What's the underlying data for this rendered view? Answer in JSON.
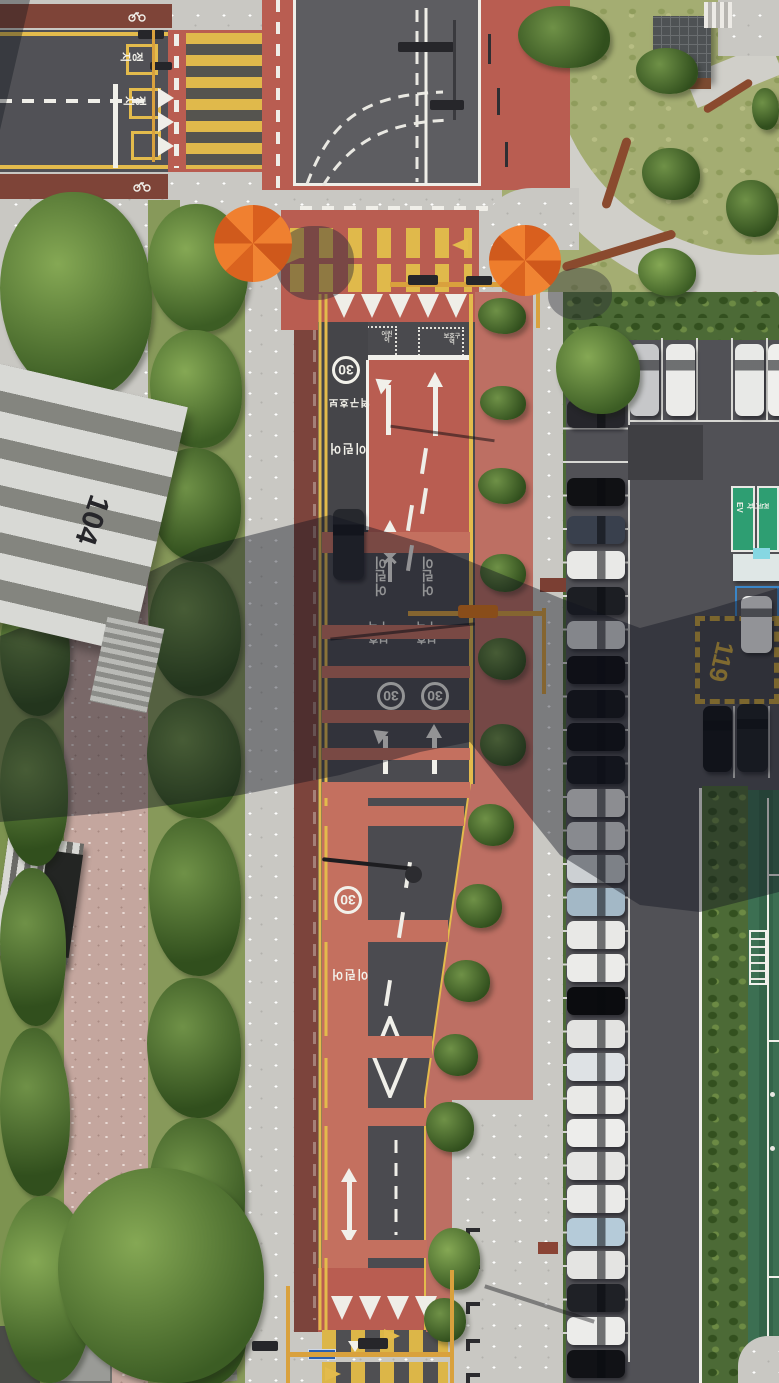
{
  "scene": {
    "type": "aerial-drone-photo",
    "description": "Top-down aerial view of a Korean school-zone street with red-painted speed zones, crosswalks, a parking lot full of cars, an apartment building casting a long diagonal shadow, a small park and a football pitch"
  },
  "texts": {
    "building_number": "104",
    "speed_limit": "30",
    "school_zone_word1": "어린이",
    "school_zone_word2": "보호구역",
    "stop_marking": "정지",
    "fire_lane_number": "119",
    "ev_label": "EV",
    "ev_korean": "전기차"
  },
  "palette": {
    "red_paint": "#b95d51",
    "red_band": "#c4705f",
    "crosswalk_yellow": "#e0b94b",
    "asphalt": "#515156",
    "sidewalk": "#c9c8c3",
    "pink_path": "#c4a69e",
    "grass": "#a4ad72",
    "field_green": "#3c6f52",
    "umbrella_orange": "#ef8030",
    "ev_green": "#2e9e72",
    "disabled_blue": "#3a86c8",
    "shadow": "rgba(16,20,30,0.42)"
  },
  "markings": {
    "bands": [
      [
        532,
        21,
        470
      ],
      [
        625,
        14,
        470
      ],
      [
        666,
        12,
        470
      ],
      [
        710,
        13,
        470
      ],
      [
        748,
        12,
        470
      ],
      [
        782,
        16,
        470
      ],
      [
        806,
        20,
        464
      ],
      [
        920,
        22,
        448
      ],
      [
        1036,
        22,
        432
      ],
      [
        1108,
        18,
        427
      ],
      [
        1240,
        18,
        427
      ]
    ],
    "teeth_down": [
      {
        "y": 294,
        "xs": [
          333,
          361,
          389,
          417,
          445
        ]
      },
      {
        "y": 1296,
        "xs": [
          331,
          359,
          387,
          415
        ]
      }
    ],
    "teeth_right": {
      "x": 158,
      "ys": [
        88,
        112,
        136
      ]
    },
    "diag_dashes": [
      [
        406,
        862
      ],
      [
        399,
        912
      ],
      [
        386,
        980
      ],
      [
        408,
        505
      ],
      [
        408,
        545
      ],
      [
        422,
        448
      ],
      [
        422,
        488
      ]
    ],
    "speed_arrows": [
      [
        286,
        250,
        0
      ],
      [
        452,
        238,
        1
      ],
      [
        384,
        1329,
        0
      ],
      [
        325,
        1367,
        0
      ]
    ]
  },
  "parking": {
    "left_column": [
      [
        400,
        "#26262b"
      ],
      [
        478,
        "#101114"
      ],
      [
        516,
        "#39404d"
      ],
      [
        551,
        "#e9e9e7"
      ],
      [
        587,
        "#1c1e23"
      ],
      [
        621,
        "#d8d9da"
      ],
      [
        656,
        "#0e0f12"
      ],
      [
        690,
        "#141519"
      ],
      [
        723,
        "#0f1013"
      ],
      [
        756,
        "#16181d"
      ],
      [
        789,
        "#e6e6e4"
      ],
      [
        822,
        "#dfe0e0"
      ],
      [
        855,
        "#ccd0d3"
      ],
      [
        888,
        "#a3b8c6"
      ],
      [
        921,
        "#e8e8e6"
      ],
      [
        954,
        "#ebebe9"
      ],
      [
        987,
        "#0b0c0f"
      ],
      [
        1020,
        "#e3e3e1"
      ],
      [
        1053,
        "#dee2e5"
      ],
      [
        1086,
        "#e9e9e7"
      ],
      [
        1119,
        "#ededeb"
      ],
      [
        1152,
        "#e6e6e4"
      ],
      [
        1185,
        "#eaeae8"
      ],
      [
        1218,
        "#b5cbd9"
      ],
      [
        1251,
        "#e4e4e2"
      ],
      [
        1284,
        "#1f2126"
      ],
      [
        1317,
        "#ececea"
      ],
      [
        1350,
        "#111216"
      ]
    ],
    "top_row": [
      [
        630,
        "#c6c7c9"
      ],
      [
        666,
        "#ebebe9"
      ],
      [
        735,
        "#e8e9e7"
      ],
      [
        768,
        "#efefed"
      ]
    ],
    "right_pair": [
      [
        703,
        706,
        29,
        66,
        "#121317"
      ],
      [
        737,
        704,
        31,
        68,
        "#1d1f24"
      ]
    ],
    "blue_stall_car": [
      741,
      596,
      31,
      57,
      "#f0f0ee"
    ]
  },
  "vehicles": {
    "van_on_road": [
      333,
      509,
      31,
      71,
      "#26282d"
    ]
  },
  "vegetation": [
    [
      0,
      192,
      152,
      206,
      0
    ],
    [
      148,
      204,
      100,
      128,
      0
    ],
    [
      150,
      330,
      92,
      118,
      0
    ],
    [
      151,
      448,
      90,
      114,
      1
    ],
    [
      149,
      562,
      92,
      134,
      1
    ],
    [
      147,
      698,
      94,
      120,
      1
    ],
    [
      149,
      818,
      92,
      158,
      1
    ],
    [
      147,
      978,
      94,
      140,
      1
    ],
    [
      149,
      1118,
      96,
      148,
      1
    ],
    [
      145,
      1266,
      102,
      122,
      1
    ],
    [
      0,
      588,
      70,
      128,
      1
    ],
    [
      0,
      718,
      68,
      148,
      1
    ],
    [
      0,
      868,
      66,
      158,
      1
    ],
    [
      0,
      1028,
      70,
      168,
      1
    ],
    [
      0,
      1196,
      92,
      187,
      0
    ],
    [
      58,
      1168,
      206,
      215,
      0
    ],
    [
      556,
      326,
      84,
      88,
      0
    ],
    [
      518,
      6,
      92,
      62,
      1
    ],
    [
      636,
      48,
      62,
      46,
      1
    ],
    [
      642,
      148,
      58,
      52,
      1
    ],
    [
      726,
      180,
      52,
      57,
      1
    ],
    [
      638,
      248,
      58,
      48,
      0
    ],
    [
      752,
      88,
      27,
      42,
      1
    ],
    [
      478,
      298,
      48,
      36,
      1
    ],
    [
      480,
      386,
      46,
      34,
      1
    ],
    [
      478,
      468,
      48,
      36,
      1
    ],
    [
      480,
      554,
      46,
      38,
      1
    ],
    [
      478,
      638,
      48,
      42,
      1
    ],
    [
      480,
      724,
      46,
      42,
      1
    ],
    [
      468,
      804,
      46,
      42,
      1
    ],
    [
      456,
      884,
      46,
      44,
      1
    ],
    [
      444,
      960,
      46,
      42,
      1
    ],
    [
      434,
      1034,
      44,
      42,
      1
    ],
    [
      426,
      1102,
      48,
      50,
      1
    ],
    [
      428,
      1228,
      52,
      62,
      0
    ],
    [
      424,
      1298,
      42,
      44,
      1
    ]
  ]
}
